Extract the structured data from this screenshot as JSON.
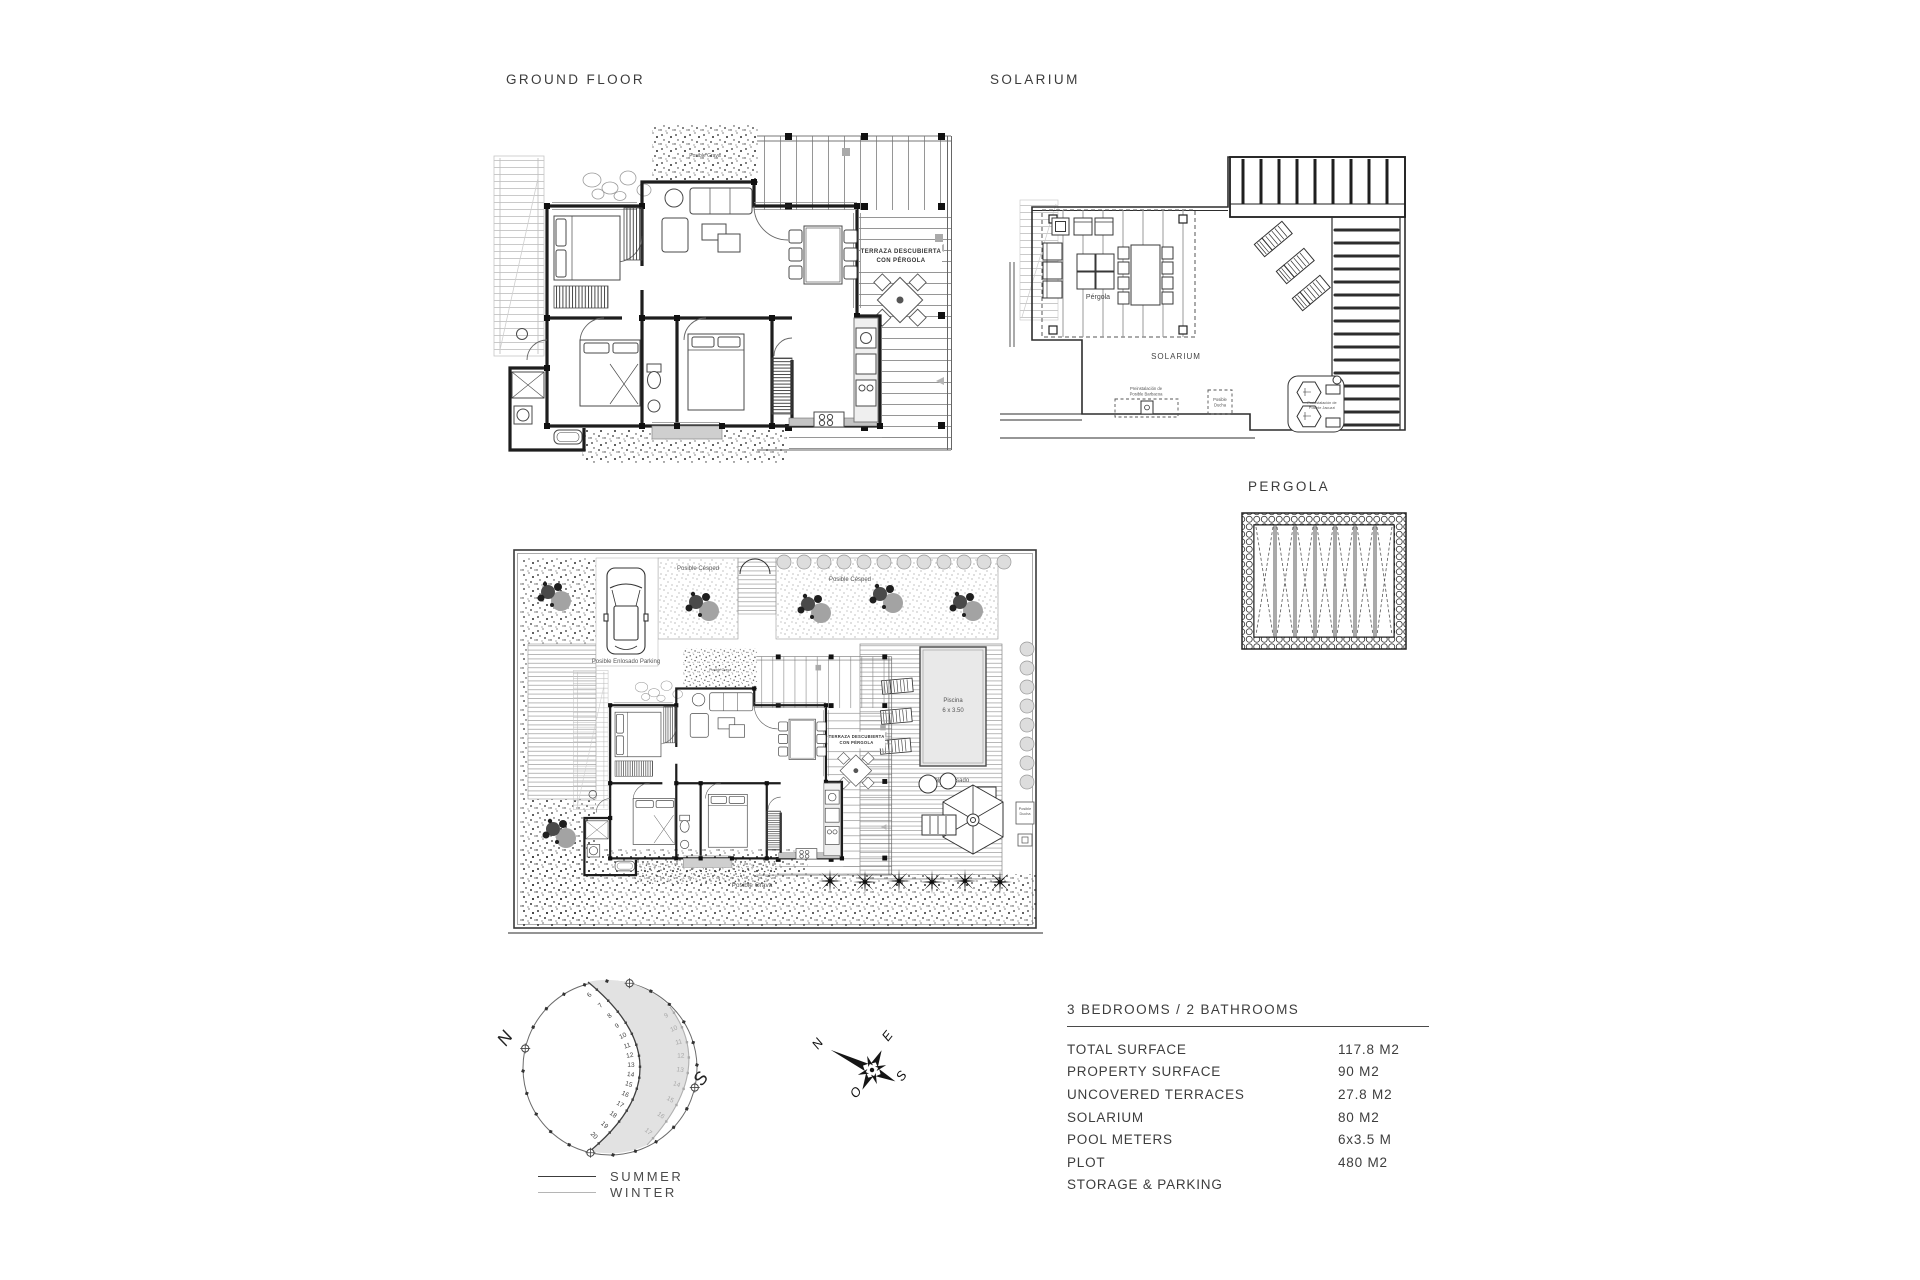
{
  "headings": {
    "ground_floor": "GROUND FLOOR",
    "solarium": "SOLARIUM",
    "pergola": "PERGOLA"
  },
  "ground_floor_plan": {
    "terrace_label_line1": "TERRAZA DESCUBIERTA",
    "terrace_label_line2": "CON PÉRGOLA",
    "gravel_label": "Posible Grava"
  },
  "solarium_plan": {
    "pergola_label": "Pérgola",
    "solarium_label": "SOLARIUM",
    "barbecue_label_line1": "Preinstalación de",
    "barbecue_label_line2": "Posible Barbacoa",
    "shower_label_line1": "Posible",
    "shower_label_line2": "Ducha",
    "jacuzzi_label_line1": "Preinstalación de",
    "jacuzzi_label_line2": "Posible Jacuzzi"
  },
  "site_plan": {
    "lawn_label_left": "Posible Césped",
    "lawn_label_right": "Posible Césped",
    "parking_label": "Posible Enlosado Parking",
    "pool_label_line1": "Piscina",
    "pool_label_line2": "6 x 3.50",
    "paving_label": "Posible Enlosado",
    "gravel_label": "Posible Grava",
    "shower_label_line1": "Posible",
    "shower_label_line2": "Ducha"
  },
  "sun_diagram": {
    "north": "N",
    "south": "S",
    "summer_hours": [
      "6",
      "7",
      "8",
      "9",
      "10",
      "11",
      "12",
      "13",
      "14",
      "15",
      "16",
      "17",
      "18",
      "19",
      "20"
    ],
    "winter_hours": [
      "9",
      "10",
      "11",
      "12",
      "13",
      "14",
      "15",
      "16",
      "17"
    ],
    "legend_summer": "SUMMER",
    "legend_winter": "WINTER",
    "colors": {
      "summer": "#3f3f3f",
      "winter": "#a8a8a8",
      "shade": "#e2e2e2"
    }
  },
  "compass": {
    "north": "N",
    "east": "E",
    "south": "S",
    "west": "O"
  },
  "spec_table": {
    "title": "3 BEDROOMS / 2 BATHROOMS",
    "rows": [
      {
        "label": "TOTAL SURFACE",
        "value": "117.8 M2"
      },
      {
        "label": "PROPERTY SURFACE",
        "value": "90 M2"
      },
      {
        "label": "UNCOVERED TERRACES",
        "value": "27.8 M2"
      },
      {
        "label": "SOLARIUM",
        "value": "80 M2"
      },
      {
        "label": "POOL METERS",
        "value": "6x3.5 M"
      },
      {
        "label": "PLOT",
        "value": "480 M2"
      },
      {
        "label": "STORAGE & PARKING",
        "value": ""
      }
    ]
  }
}
